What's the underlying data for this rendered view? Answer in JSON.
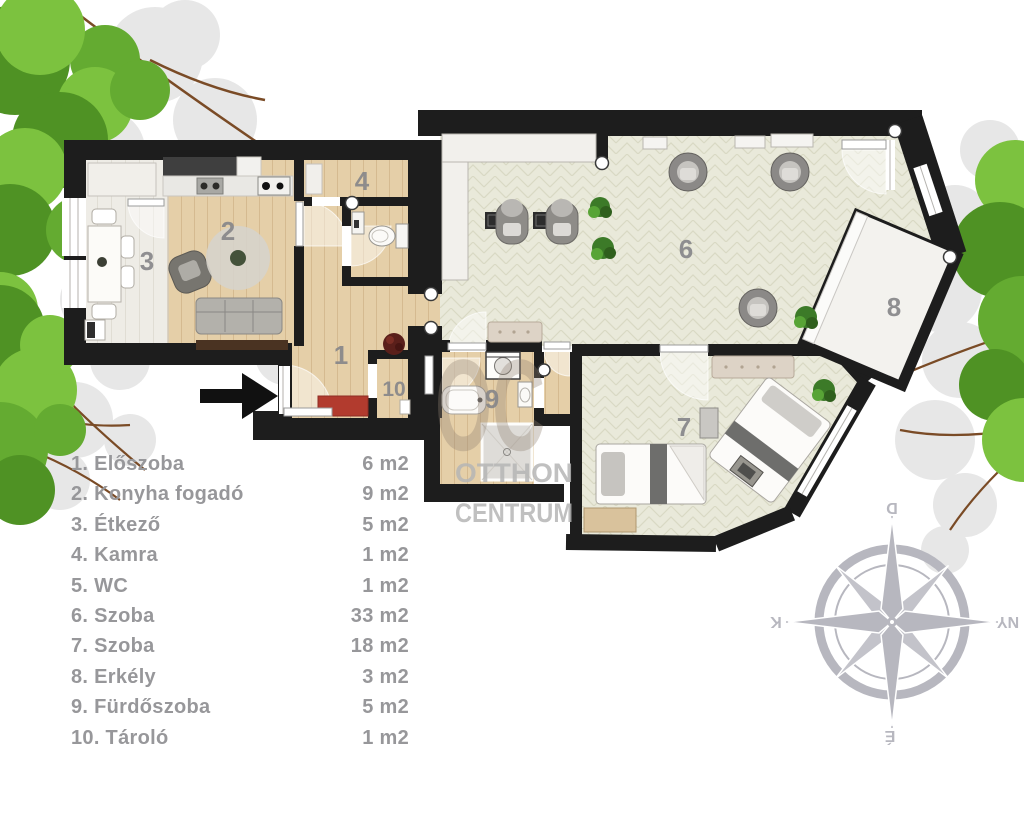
{
  "legend": {
    "items": [
      {
        "label": "1. Előszoba",
        "area": "6 m2"
      },
      {
        "label": "2. Konyha fogadó",
        "area": "9 m2"
      },
      {
        "label": "3. Étkező",
        "area": "5 m2"
      },
      {
        "label": "4. Kamra",
        "area": "1 m2"
      },
      {
        "label": "5. WC",
        "area": "1 m2"
      },
      {
        "label": "6. Szoba",
        "area": "33 m2"
      },
      {
        "label": "7. Szoba",
        "area": "18 m2"
      },
      {
        "label": "8. Erkély",
        "area": "3 m2"
      },
      {
        "label": "9. Fürdőszoba",
        "area": "5 m2"
      },
      {
        "label": "10. Tároló",
        "area": "1 m2"
      }
    ]
  },
  "plan": {
    "numbers": {
      "n1": "1",
      "n2": "2",
      "n3": "3",
      "n4": "4",
      "n6": "6",
      "n7": "7",
      "n8": "8",
      "n9": "9",
      "n10": "10"
    }
  },
  "watermark": {
    "logo": "OC",
    "line1": "OTTHON",
    "line2": "CENTRUM"
  },
  "compass": {
    "top": "D",
    "right": "NY",
    "bottom": "É",
    "left": "K"
  },
  "colors": {
    "wall": "#1d1d1d",
    "wood": "#e5cfa8",
    "herringbone": "#e9e9da",
    "dining_floor": "#eeece6",
    "accent_red": "#b23b2e",
    "legend_text": "#97979a",
    "room_number": "#87878a",
    "compass": "#b7b7bf",
    "watermark_logo": "#8f8171",
    "watermark_text": "#b5b5b5",
    "leaf_green_light": "#7cc23f",
    "leaf_green_mid": "#64ab31",
    "leaf_green_dark": "#4f9224",
    "branch": "#7a4b26",
    "leaf_shadow": "#e7e7e7"
  }
}
